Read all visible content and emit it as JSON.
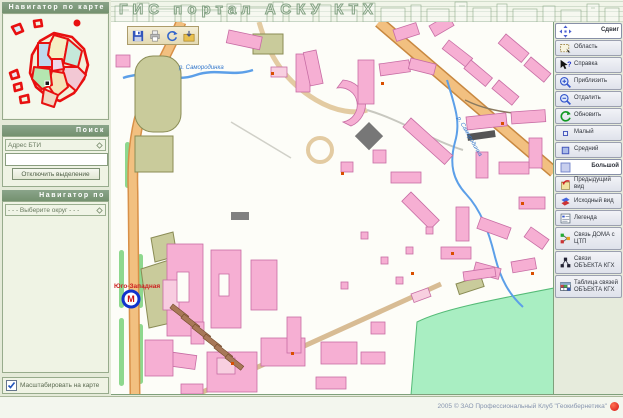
{
  "header": {
    "title": "ГИС портал АСКУ КТХ"
  },
  "left_panel": {
    "map_navigator": {
      "title": "Навигатор по карте"
    },
    "search": {
      "title": "Поиск",
      "field_selector": "Адрес БТИ",
      "query_value": "",
      "clear_selection_button": "Отключить выделение"
    },
    "district_navigator": {
      "title": "Навигатор по районам",
      "select_placeholder": "- - - Выберите округ - - -"
    },
    "scale_checkbox": {
      "label": "Масштабировать на карте",
      "checked": true
    }
  },
  "map": {
    "labels": {
      "river_top": "р. Самородинка",
      "river_right": "р. Самородинка",
      "metro_station": "Юго-Западная",
      "metro_letter": "М"
    },
    "toolbar": {
      "save": "save",
      "print": "print",
      "refresh": "refresh",
      "export": "export"
    }
  },
  "right_toolbar": {
    "buttons": [
      {
        "label": "Сдвиг",
        "icon": "pan-icon",
        "active": true
      },
      {
        "label": "Область",
        "icon": "area-select-icon",
        "active": false
      },
      {
        "label": "Справка",
        "icon": "info-cursor-icon",
        "active": false
      },
      {
        "label": "Приблизить",
        "icon": "zoom-in-icon",
        "active": false
      },
      {
        "label": "Отдалить",
        "icon": "zoom-out-icon",
        "active": false
      },
      {
        "label": "Обновить",
        "icon": "refresh-icon",
        "active": false
      },
      {
        "label": "Малый",
        "icon": "size-small-icon",
        "active": false
      },
      {
        "label": "Средний",
        "icon": "size-medium-icon",
        "active": false
      },
      {
        "label": "Большой",
        "icon": "size-large-icon",
        "active": true
      },
      {
        "label": "Предыдущий вид",
        "icon": "previous-view-icon",
        "active": false
      },
      {
        "label": "Исходный вид",
        "icon": "initial-view-icon",
        "active": false
      },
      {
        "label": "Легенда",
        "icon": "legend-icon",
        "active": false
      },
      {
        "label": "Связь ДОМА с ЦТП",
        "icon": "house-ctp-link-icon",
        "active": false
      },
      {
        "label": "Связи ОБЪЕКТА КГХ",
        "icon": "object-links-icon",
        "active": false
      },
      {
        "label": "Таблица связей ОБЪЕКТА КГХ",
        "icon": "links-table-icon",
        "active": false
      }
    ]
  },
  "status_bar": {
    "copyright": "2005 © ЗАО Профессиональный Клуб \"Геокибернетика\""
  },
  "colors": {
    "panel_header_green": "#7E9A7E",
    "panel_bg": "#EFF3E4",
    "building_pink": "#F6AFD3",
    "building_khaki": "#C9CB9B",
    "road_orange": "#F2C080",
    "park_green": "#A9EEC2",
    "river_blue": "#5C9FE8",
    "minimap_outline_red": "#E81010",
    "metro_red": "#CC1111",
    "metro_blue": "#1133CC"
  }
}
